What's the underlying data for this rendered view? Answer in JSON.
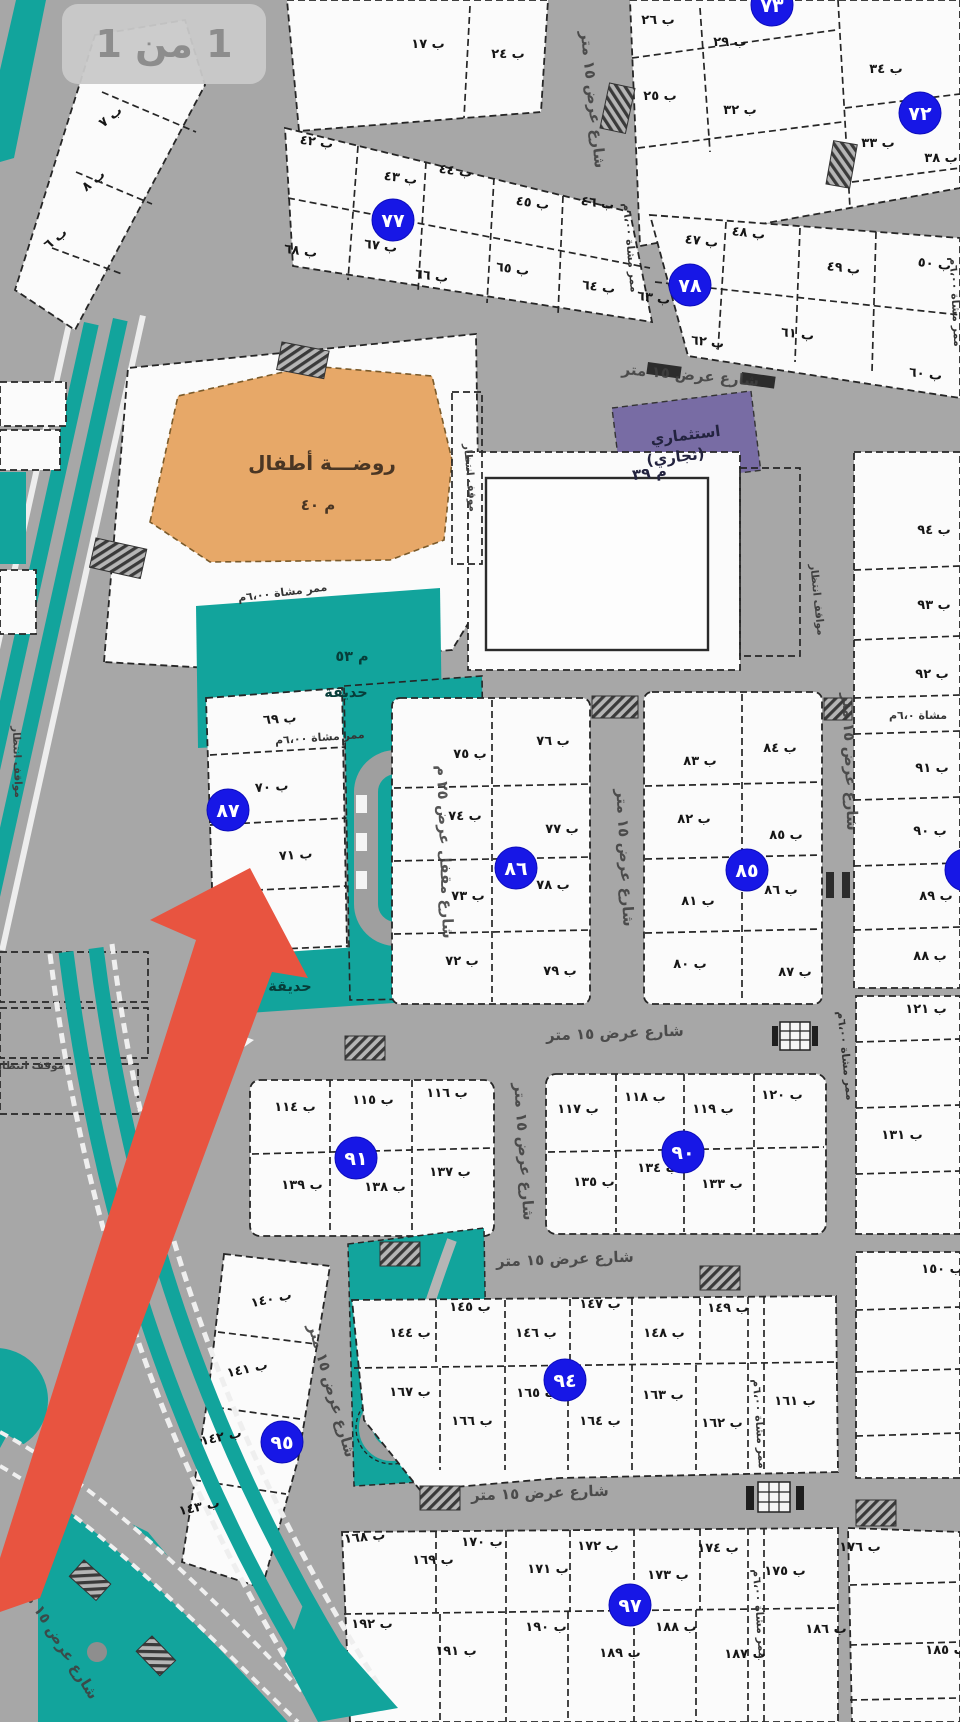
{
  "page": {
    "badge_label": "1 من 1"
  },
  "colors": {
    "road": "#a7a7a7",
    "plot": "#fbfbfb",
    "park_teal": "#12a49c",
    "kindergarten_orange": "#e7a868",
    "commercial_purple": "#786ca4",
    "block_badge_blue": "#1717e6",
    "arrow_red": "#e85440",
    "badge_bg": "#c9c9c9",
    "badge_text": "#8d8d8d",
    "line": "#262626"
  },
  "arrow": {
    "points_to_block": "٨٧"
  },
  "zones": {
    "kindergarten": {
      "title": "روضـــة أطفال",
      "code": "م ٤٠"
    },
    "commercial": {
      "line1": "استثماري",
      "line2": "(تجاري)",
      "code": "م ٣٩"
    },
    "garden_53": {
      "code": "م ٥٣",
      "name": "حديقة"
    },
    "garden_small": {
      "name": "حديقة"
    }
  },
  "block_badges": [
    {
      "n": "٧٣",
      "x": 772,
      "y": 5
    },
    {
      "n": "٧٢",
      "x": 920,
      "y": 113
    },
    {
      "n": "٧٧",
      "x": 393,
      "y": 220
    },
    {
      "n": "٧٨",
      "x": 690,
      "y": 285
    },
    {
      "n": "٨٦",
      "x": 516,
      "y": 868
    },
    {
      "n": "٨٥",
      "x": 747,
      "y": 870
    },
    {
      "n": "٨٧",
      "x": 228,
      "y": 810
    },
    {
      "n": "٩١",
      "x": 356,
      "y": 1158
    },
    {
      "n": "٩٠",
      "x": 683,
      "y": 1152
    },
    {
      "n": "٩٥",
      "x": 282,
      "y": 1442
    },
    {
      "n": "٩٤",
      "x": 565,
      "y": 1380
    },
    {
      "n": "٩٧",
      "x": 630,
      "y": 1605
    },
    {
      "n": "",
      "x": 966,
      "y": 870
    }
  ],
  "labels": [
    {
      "t": "ب ٧",
      "x": 113,
      "y": 120,
      "r": -38,
      "c": "p"
    },
    {
      "t": "ب ٨",
      "x": 96,
      "y": 184,
      "r": -38,
      "c": "p"
    },
    {
      "t": "ب ٦",
      "x": 58,
      "y": 242,
      "r": -38,
      "c": "p"
    },
    {
      "t": "ب ١٧",
      "x": 428,
      "y": 48,
      "r": 0,
      "c": "p"
    },
    {
      "t": "ب ٢٤",
      "x": 508,
      "y": 58,
      "r": 0,
      "c": "p"
    },
    {
      "t": "ب ٢٦",
      "x": 658,
      "y": 24,
      "r": 0,
      "c": "p"
    },
    {
      "t": "ب ٢٩",
      "x": 730,
      "y": 46,
      "r": 0,
      "c": "p"
    },
    {
      "t": "ب ٢٥",
      "x": 660,
      "y": 100,
      "r": 0,
      "c": "p"
    },
    {
      "t": "ب ٣٢",
      "x": 740,
      "y": 114,
      "r": 0,
      "c": "p"
    },
    {
      "t": "ب ٣٤",
      "x": 886,
      "y": 73,
      "r": 0,
      "c": "p"
    },
    {
      "t": "ب ٣٣",
      "x": 878,
      "y": 147,
      "r": 0,
      "c": "p"
    },
    {
      "t": "ب ٣٨",
      "x": 941,
      "y": 162,
      "r": 0,
      "c": "p"
    },
    {
      "t": "ب ٤٢",
      "x": 316,
      "y": 146,
      "r": 8,
      "c": "p"
    },
    {
      "t": "ب ٤٣",
      "x": 400,
      "y": 182,
      "r": 8,
      "c": "p"
    },
    {
      "t": "ب ٤٤",
      "x": 455,
      "y": 175,
      "r": 8,
      "c": "p"
    },
    {
      "t": "ب ٤٥",
      "x": 532,
      "y": 207,
      "r": 8,
      "c": "p"
    },
    {
      "t": "ب ٤٦",
      "x": 597,
      "y": 207,
      "r": 8,
      "c": "p"
    },
    {
      "t": "ب ٦٨",
      "x": 300,
      "y": 255,
      "r": 8,
      "c": "p"
    },
    {
      "t": "ب ٦٧",
      "x": 380,
      "y": 250,
      "r": 8,
      "c": "p"
    },
    {
      "t": "ب ٦٦",
      "x": 431,
      "y": 280,
      "r": 8,
      "c": "p"
    },
    {
      "t": "ب ٦٥",
      "x": 512,
      "y": 273,
      "r": 8,
      "c": "p"
    },
    {
      "t": "ب ٦٤",
      "x": 598,
      "y": 291,
      "r": 8,
      "c": "p"
    },
    {
      "t": "ب ٦٣",
      "x": 653,
      "y": 302,
      "r": 8,
      "c": "p"
    },
    {
      "t": "ب ٤٧",
      "x": 701,
      "y": 245,
      "r": 7,
      "c": "p"
    },
    {
      "t": "ب ٤٨",
      "x": 748,
      "y": 237,
      "r": 7,
      "c": "p"
    },
    {
      "t": "ب ٤٩",
      "x": 843,
      "y": 272,
      "r": 7,
      "c": "p"
    },
    {
      "t": "ب ٥٠",
      "x": 934,
      "y": 268,
      "r": 7,
      "c": "p"
    },
    {
      "t": "ب ٦٢",
      "x": 707,
      "y": 346,
      "r": 7,
      "c": "p"
    },
    {
      "t": "ب ٦١",
      "x": 797,
      "y": 338,
      "r": 7,
      "c": "p"
    },
    {
      "t": "ب ٦٠",
      "x": 925,
      "y": 378,
      "r": 7,
      "c": "p"
    },
    {
      "t": "ب ٩٤",
      "x": 934,
      "y": 534,
      "r": 0,
      "c": "p"
    },
    {
      "t": "ب ٩٣",
      "x": 934,
      "y": 609,
      "r": 0,
      "c": "p"
    },
    {
      "t": "ب ٩٢",
      "x": 932,
      "y": 678,
      "r": 0,
      "c": "p"
    },
    {
      "t": "ب ٩١",
      "x": 932,
      "y": 772,
      "r": 0,
      "c": "p"
    },
    {
      "t": "ب ٩٠",
      "x": 930,
      "y": 835,
      "r": 0,
      "c": "p"
    },
    {
      "t": "ب ٨٩",
      "x": 936,
      "y": 900,
      "r": 0,
      "c": "p"
    },
    {
      "t": "ب ٨٨",
      "x": 930,
      "y": 960,
      "r": 0,
      "c": "p"
    },
    {
      "t": "ب ٧٥",
      "x": 470,
      "y": 758,
      "r": 0,
      "c": "p"
    },
    {
      "t": "ب ٧٦",
      "x": 553,
      "y": 745,
      "r": 0,
      "c": "p"
    },
    {
      "t": "ب ٧٤",
      "x": 465,
      "y": 820,
      "r": 0,
      "c": "p"
    },
    {
      "t": "ب ٧٧",
      "x": 562,
      "y": 833,
      "r": 0,
      "c": "p"
    },
    {
      "t": "ب ٧٣",
      "x": 468,
      "y": 900,
      "r": 0,
      "c": "p"
    },
    {
      "t": "ب ٧٨",
      "x": 553,
      "y": 889,
      "r": 0,
      "c": "p"
    },
    {
      "t": "ب ٧٢",
      "x": 462,
      "y": 965,
      "r": 0,
      "c": "p"
    },
    {
      "t": "ب ٧٩",
      "x": 560,
      "y": 975,
      "r": 0,
      "c": "p"
    },
    {
      "t": "ب ٨٣",
      "x": 700,
      "y": 765,
      "r": 0,
      "c": "p"
    },
    {
      "t": "ب ٨٤",
      "x": 780,
      "y": 752,
      "r": 0,
      "c": "p"
    },
    {
      "t": "ب ٨٢",
      "x": 694,
      "y": 823,
      "r": 0,
      "c": "p"
    },
    {
      "t": "ب ٨٥",
      "x": 786,
      "y": 839,
      "r": 0,
      "c": "p"
    },
    {
      "t": "ب ٨١",
      "x": 698,
      "y": 905,
      "r": 0,
      "c": "p"
    },
    {
      "t": "ب ٨٦",
      "x": 781,
      "y": 894,
      "r": 0,
      "c": "p"
    },
    {
      "t": "ب ٨٠",
      "x": 690,
      "y": 968,
      "r": 0,
      "c": "p"
    },
    {
      "t": "ب ٨٧",
      "x": 795,
      "y": 976,
      "r": 0,
      "c": "p"
    },
    {
      "t": "ب ٦٩",
      "x": 280,
      "y": 723,
      "r": -4,
      "c": "p"
    },
    {
      "t": "ب ٧٠",
      "x": 272,
      "y": 791,
      "r": -4,
      "c": "p"
    },
    {
      "t": "ب ٧١",
      "x": 296,
      "y": 859,
      "r": -4,
      "c": "p"
    },
    {
      "t": "ب ١١٤",
      "x": 295,
      "y": 1111,
      "r": 0,
      "c": "p"
    },
    {
      "t": "ب ١١٥",
      "x": 373,
      "y": 1104,
      "r": 0,
      "c": "p"
    },
    {
      "t": "ب ١١٦",
      "x": 447,
      "y": 1097,
      "r": 0,
      "c": "p"
    },
    {
      "t": "ب ١٣٩",
      "x": 302,
      "y": 1189,
      "r": 0,
      "c": "p"
    },
    {
      "t": "ب ١٣٨",
      "x": 385,
      "y": 1191,
      "r": 0,
      "c": "p"
    },
    {
      "t": "ب ١٣٧",
      "x": 450,
      "y": 1176,
      "r": 0,
      "c": "p"
    },
    {
      "t": "ب ١١٧",
      "x": 578,
      "y": 1113,
      "r": 0,
      "c": "p"
    },
    {
      "t": "ب ١١٨",
      "x": 645,
      "y": 1101,
      "r": 0,
      "c": "p"
    },
    {
      "t": "ب ١١٩",
      "x": 713,
      "y": 1113,
      "r": 0,
      "c": "p"
    },
    {
      "t": "ب ١٢٠",
      "x": 782,
      "y": 1099,
      "r": 0,
      "c": "p"
    },
    {
      "t": "ب ١٣٥",
      "x": 594,
      "y": 1186,
      "r": 0,
      "c": "p"
    },
    {
      "t": "ب ١٣٤",
      "x": 658,
      "y": 1172,
      "r": 0,
      "c": "p"
    },
    {
      "t": "ب ١٣٣",
      "x": 722,
      "y": 1188,
      "r": 0,
      "c": "p"
    },
    {
      "t": "ب ١٢١",
      "x": 926,
      "y": 1013,
      "r": 0,
      "c": "p"
    },
    {
      "t": "ب ١٣١",
      "x": 902,
      "y": 1139,
      "r": 0,
      "c": "p"
    },
    {
      "t": "ب ١٤٠",
      "x": 272,
      "y": 1303,
      "r": -12,
      "c": "p"
    },
    {
      "t": "ب ١٤١",
      "x": 248,
      "y": 1373,
      "r": -12,
      "c": "p"
    },
    {
      "t": "ب ١٤٢",
      "x": 222,
      "y": 1441,
      "r": -12,
      "c": "p"
    },
    {
      "t": "ب ١٤٣",
      "x": 200,
      "y": 1511,
      "r": -12,
      "c": "p"
    },
    {
      "t": "ب ١٤٥",
      "x": 470,
      "y": 1311,
      "r": 0,
      "c": "p"
    },
    {
      "t": "ب ١٤٧",
      "x": 600,
      "y": 1308,
      "r": 0,
      "c": "p"
    },
    {
      "t": "ب ١٤٩",
      "x": 728,
      "y": 1312,
      "r": 0,
      "c": "p"
    },
    {
      "t": "ب ١٤٤",
      "x": 410,
      "y": 1337,
      "r": 0,
      "c": "p"
    },
    {
      "t": "ب ١٤٦",
      "x": 536,
      "y": 1337,
      "r": 0,
      "c": "p"
    },
    {
      "t": "ب ١٤٨",
      "x": 664,
      "y": 1337,
      "r": 0,
      "c": "p"
    },
    {
      "t": "ب ١٥٠",
      "x": 942,
      "y": 1273,
      "r": 0,
      "c": "p"
    },
    {
      "t": "ب ١٦٧",
      "x": 410,
      "y": 1396,
      "r": 0,
      "c": "p"
    },
    {
      "t": "ب ١٦٥",
      "x": 537,
      "y": 1397,
      "r": 0,
      "c": "p"
    },
    {
      "t": "ب ١٦٣",
      "x": 663,
      "y": 1399,
      "r": 0,
      "c": "p"
    },
    {
      "t": "ب ١٦١",
      "x": 795,
      "y": 1405,
      "r": 0,
      "c": "p"
    },
    {
      "t": "ب ١٦٦",
      "x": 472,
      "y": 1425,
      "r": 0,
      "c": "p"
    },
    {
      "t": "ب ١٦٤",
      "x": 600,
      "y": 1425,
      "r": 0,
      "c": "p"
    },
    {
      "t": "ب ١٦٢",
      "x": 722,
      "y": 1427,
      "r": 0,
      "c": "p"
    },
    {
      "t": "ب ١٦٨",
      "x": 365,
      "y": 1541,
      "r": -6,
      "c": "p"
    },
    {
      "t": "ب ١٧٠",
      "x": 482,
      "y": 1546,
      "r": 0,
      "c": "p"
    },
    {
      "t": "ب ١٧٢",
      "x": 598,
      "y": 1550,
      "r": 0,
      "c": "p"
    },
    {
      "t": "ب ١٧٤",
      "x": 718,
      "y": 1552,
      "r": 0,
      "c": "p"
    },
    {
      "t": "ب ١٧٦",
      "x": 860,
      "y": 1551,
      "r": 0,
      "c": "p"
    },
    {
      "t": "ب ١٦٩",
      "x": 433,
      "y": 1564,
      "r": 0,
      "c": "p"
    },
    {
      "t": "ب ١٧١",
      "x": 548,
      "y": 1573,
      "r": 0,
      "c": "p"
    },
    {
      "t": "ب ١٧٣",
      "x": 668,
      "y": 1579,
      "r": 0,
      "c": "p"
    },
    {
      "t": "ب ١٧٥",
      "x": 785,
      "y": 1575,
      "r": 0,
      "c": "p"
    },
    {
      "t": "ب ١٩٢",
      "x": 372,
      "y": 1628,
      "r": 0,
      "c": "p"
    },
    {
      "t": "ب ١٩١",
      "x": 456,
      "y": 1655,
      "r": 0,
      "c": "p"
    },
    {
      "t": "ب ١٩٠",
      "x": 546,
      "y": 1631,
      "r": 0,
      "c": "p"
    },
    {
      "t": "ب ١٨٩",
      "x": 620,
      "y": 1657,
      "r": 0,
      "c": "p"
    },
    {
      "t": "ب ١٨٨",
      "x": 676,
      "y": 1631,
      "r": 0,
      "c": "p"
    },
    {
      "t": "ب ١٨٧",
      "x": 745,
      "y": 1658,
      "r": 0,
      "c": "p"
    },
    {
      "t": "ب ١٨٦",
      "x": 826,
      "y": 1633,
      "r": 0,
      "c": "p"
    },
    {
      "t": "ب ١٨٥",
      "x": 946,
      "y": 1654,
      "r": 0,
      "c": "p"
    },
    {
      "t": "شارع عرض ١٥ متر",
      "x": 588,
      "y": 100,
      "r": 84,
      "c": "s"
    },
    {
      "t": "شارع عرض ١٥ متر",
      "x": 690,
      "y": 380,
      "r": 5,
      "c": "s"
    },
    {
      "t": "شارع عرض ١٥ متر",
      "x": 620,
      "y": 858,
      "r": 87,
      "c": "s"
    },
    {
      "t": "شارع عرض ١٥ متر",
      "x": 845,
      "y": 762,
      "r": 88,
      "c": "s"
    },
    {
      "t": "شارع عرض ١٥ متر",
      "x": 615,
      "y": 1038,
      "r": -2,
      "c": "s"
    },
    {
      "t": "شارع عرض ١٥ متر",
      "x": 519,
      "y": 1152,
      "r": 86,
      "c": "s"
    },
    {
      "t": "شارع عرض ١٥ متر",
      "x": 565,
      "y": 1264,
      "r": -2,
      "c": "s"
    },
    {
      "t": "شارع عرض ١٥ متر",
      "x": 540,
      "y": 1498,
      "r": -2,
      "c": "s"
    },
    {
      "t": "شارع عرض ١٥ متر",
      "x": 327,
      "y": 1392,
      "r": 74,
      "c": "s"
    },
    {
      "t": "شارع عرض ١٥ متر",
      "x": 54,
      "y": 1642,
      "r": 58,
      "c": "s"
    },
    {
      "t": "شارع مقفل عرض ٢٥ م",
      "x": 440,
      "y": 852,
      "r": 88,
      "c": "s"
    },
    {
      "t": "ممر مشاة ٦،٠٠م",
      "x": 283,
      "y": 596,
      "r": -7,
      "c": "pa"
    },
    {
      "t": "ممر مشاة ٦،٠٠م",
      "x": 320,
      "y": 741,
      "r": -4,
      "c": "pa"
    },
    {
      "t": "مشاة ٦،٠م",
      "x": 918,
      "y": 719,
      "r": 0,
      "c": "pa"
    },
    {
      "t": "ممر مشاة ٦،٠٠م",
      "x": 842,
      "y": 1056,
      "r": 84,
      "c": "pa"
    },
    {
      "t": "ممر مشاة ٦،٠٠م",
      "x": 756,
      "y": 1424,
      "r": 86,
      "c": "pa"
    },
    {
      "t": "ممر مشاة ٦،٠٠م",
      "x": 756,
      "y": 1614,
      "r": 86,
      "c": "pa"
    },
    {
      "t": "ممر مشاة ٦،٠٠م",
      "x": 627,
      "y": 248,
      "r": 85,
      "c": "pa"
    },
    {
      "t": "ممر مشاة ٦،٠٠م",
      "x": 952,
      "y": 302,
      "r": 87,
      "c": "pa"
    },
    {
      "t": "موقف انتظار",
      "x": 467,
      "y": 478,
      "r": 85,
      "c": "pk"
    },
    {
      "t": "مواقف انتظار",
      "x": 814,
      "y": 600,
      "r": 84,
      "c": "pk"
    },
    {
      "t": "موقف انتظار",
      "x": 30,
      "y": 1069,
      "r": 0,
      "c": "pk"
    },
    {
      "t": "مواقف انتظار",
      "x": 14,
      "y": 762,
      "r": 88,
      "c": "pk"
    },
    {
      "t": "روضـــة أطفال",
      "x": 322,
      "y": 470,
      "r": 0,
      "c": "zt"
    },
    {
      "t": "م ٤٠",
      "x": 318,
      "y": 510,
      "r": 0,
      "c": "zs"
    },
    {
      "t": "م ٥٣",
      "x": 352,
      "y": 661,
      "r": 0,
      "c": "g"
    },
    {
      "t": "حديقة",
      "x": 346,
      "y": 697,
      "r": 0,
      "c": "g"
    },
    {
      "t": "حديقة",
      "x": 290,
      "y": 991,
      "r": 0,
      "c": "g"
    },
    {
      "t": "استثماري",
      "x": 686,
      "y": 440,
      "r": -7,
      "c": "zp"
    },
    {
      "t": "(تجاري)",
      "x": 676,
      "y": 462,
      "r": -7,
      "c": "zp"
    },
    {
      "t": "م ٣٩",
      "x": 650,
      "y": 478,
      "r": -7,
      "c": "zp"
    }
  ]
}
